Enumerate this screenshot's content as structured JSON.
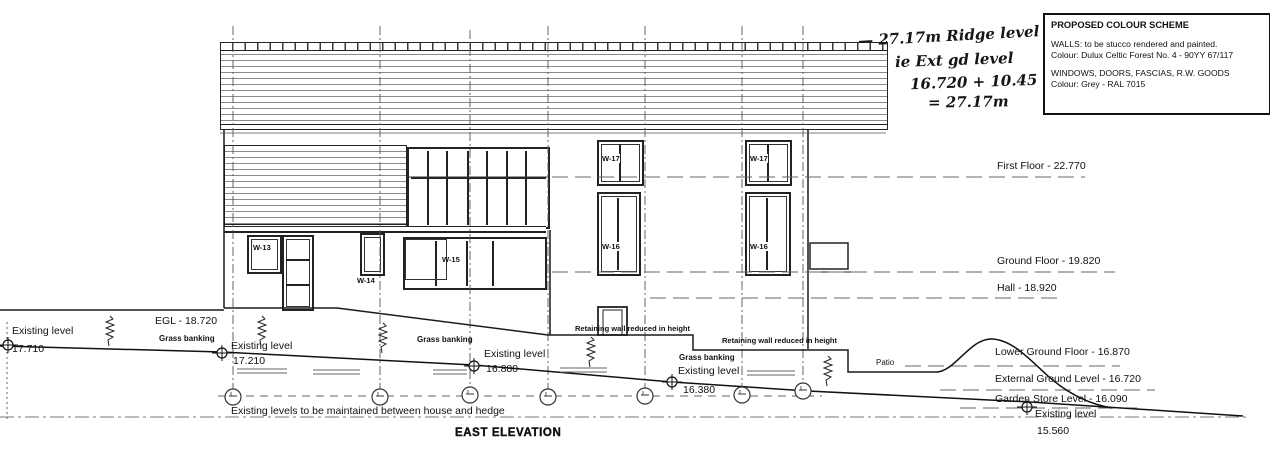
{
  "title": "EAST ELEVATION",
  "colour_scheme": {
    "title": "PROPOSED COLOUR SCHEME",
    "walls_line1": "WALLS: to be stucco rendered and painted.",
    "walls_line2": "Colour: Dulux Celtic Forest No. 4 - 90YY 67/117",
    "windows_line1": "WINDOWS, DOORS, FASCIAS, R.W. GOODS",
    "windows_line2": "Colour: Grey - RAL 7015"
  },
  "handwritten_note": {
    "line1": "— 27.17m Ridge level",
    "line2": "ie Ext gd level",
    "line3": "16.720 + 10.45",
    "line4": "= 27.17m"
  },
  "floor_levels": {
    "first_floor": "First Floor - 22.770",
    "ground_floor": "Ground Floor - 19.820",
    "hall": "Hall - 18.920",
    "lower_ground_floor": "Lower Ground Floor - 16.870",
    "external_ground_level": "External Ground Level - 16.720",
    "garden_store_level": "Garden Store Level - 16.090",
    "existing_level_label": "Existing level",
    "existing_level_value": "15.560"
  },
  "ground_annotations": {
    "egl": "EGL - 18.720",
    "grass_banking": "Grass banking",
    "retaining_wall": "Retaining wall reduced in height",
    "patio": "Patio",
    "maintain_note": "Existing levels to be maintained between house and hedge",
    "existing_levels": [
      {
        "label": "Existing level",
        "value": "17.710"
      },
      {
        "label": "Existing level",
        "value": "17.210"
      },
      {
        "label": "Existing level",
        "value": "16.880"
      },
      {
        "label": "Existing level",
        "value": "16.380"
      }
    ]
  },
  "window_labels": {
    "w13": "W-13",
    "w14": "W-14",
    "w15": "W-15",
    "w16": "W-16",
    "w17": "W-17"
  }
}
